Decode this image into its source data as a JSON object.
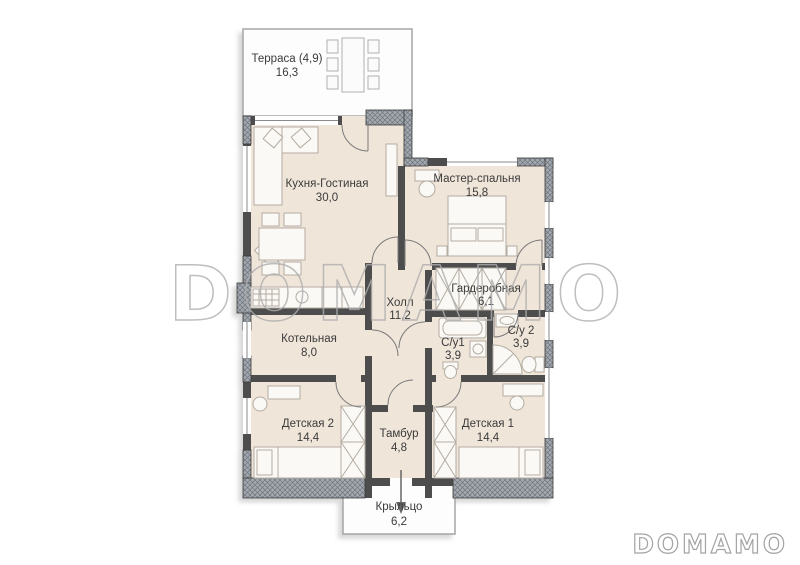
{
  "watermark": {
    "center_text": "DOMAMO",
    "corner_text": "DOMAMO",
    "color": "#aeaeae"
  },
  "palette": {
    "room_fill": "#f0e5d9",
    "wall": "#4d4d4d",
    "hatch_fill": "#a3a9af",
    "outline_light": "#a5a5a5",
    "furniture_stroke": "#b3aca1",
    "label": "#3b3b3b"
  },
  "rooms": {
    "terrace": {
      "name": "Терраса (4,9)",
      "area": "16,3"
    },
    "kitchen": {
      "name": "Кухня-Гостиная",
      "area": "30,0"
    },
    "master": {
      "name": "Мастер-спальня",
      "area": "15,8"
    },
    "hall": {
      "name": "Холл",
      "area": "11,2"
    },
    "wardrobe": {
      "name": "Гардеробная",
      "area": "6,1"
    },
    "boiler": {
      "name": "Котельная",
      "area": "8,0"
    },
    "bath1": {
      "name": "С/у1",
      "area": "3,9"
    },
    "bath2": {
      "name": "С/у 2",
      "area": "3,9"
    },
    "kids2": {
      "name": "Детская 2",
      "area": "14,4"
    },
    "kids1": {
      "name": "Детская 1",
      "area": "14,4"
    },
    "vestibule": {
      "name": "Тамбур",
      "area": "4,8"
    },
    "porch": {
      "name": "Крыльцо",
      "area": "6,2"
    }
  }
}
